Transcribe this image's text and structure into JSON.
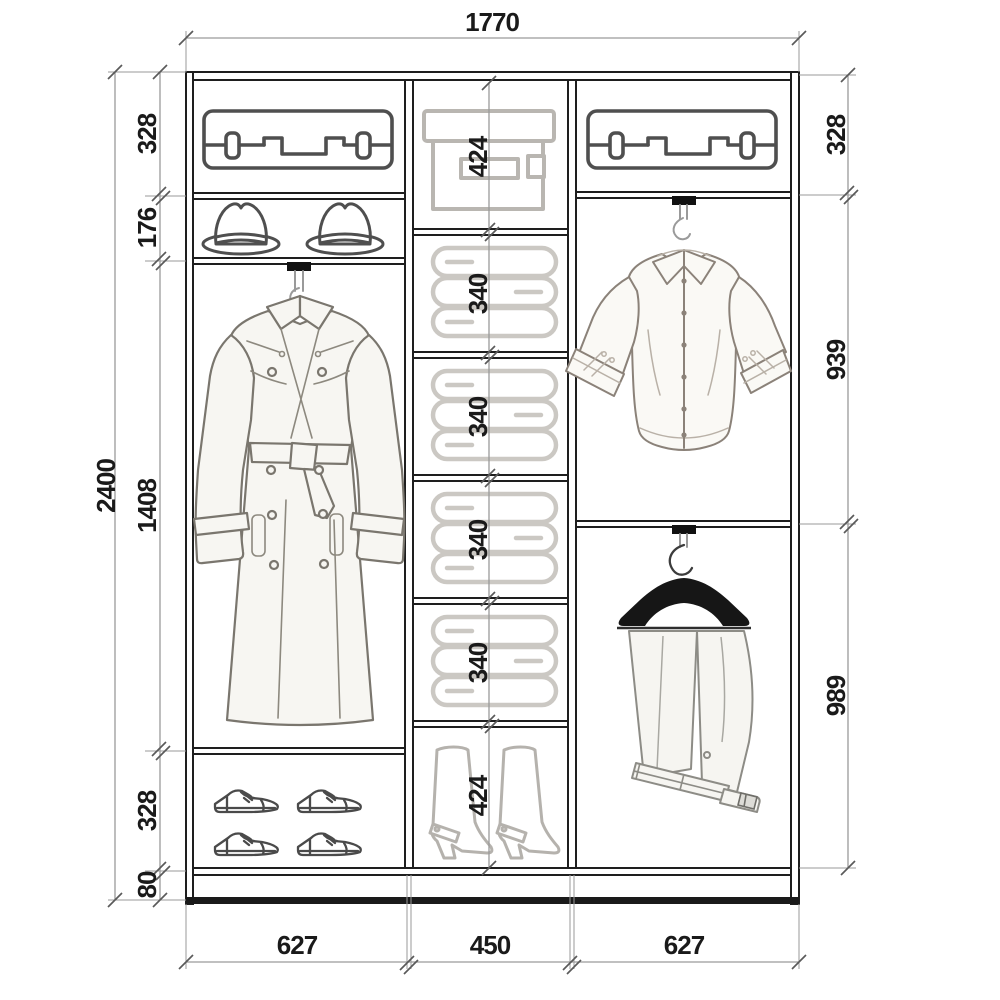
{
  "drawing": {
    "type": "wardrobe-interior-elevation",
    "units": "mm"
  },
  "dimensions": {
    "width_total": "1770",
    "height_total": "2400",
    "left": [
      "328",
      "176",
      "1408",
      "328",
      "80"
    ],
    "middle": [
      "424",
      "340",
      "340",
      "340",
      "340",
      "424"
    ],
    "right": [
      "328",
      "939",
      "989"
    ],
    "bottom": [
      "627",
      "450",
      "627"
    ]
  },
  "icons": {
    "left_column": [
      "suitcase-icon",
      "fedora-hats-icon",
      "trench-coat-icon",
      "dress-shoes-icon"
    ],
    "middle_column": [
      "storage-box-icon",
      "folded-linen-icon",
      "folded-linen-icon",
      "folded-linen-icon",
      "folded-linen-icon",
      "high-boots-icon"
    ],
    "right_column": [
      "suitcase-icon",
      "dress-shirt-icon",
      "trousers-icon"
    ],
    "hardware": [
      "hanger-rail-icon",
      "hanger-hook-icon",
      "wooden-hanger-icon"
    ]
  },
  "colors": {
    "frame": "#1e1e1e",
    "dimension_line": "#9a9a9a",
    "dimension_text": "#1a1a1a",
    "dark_icon": "#4f4f4f",
    "light_icon": "#b9b6b1",
    "garment_fill": "#f7f6f2",
    "hanger_black": "#141414",
    "background": "#ffffff"
  }
}
